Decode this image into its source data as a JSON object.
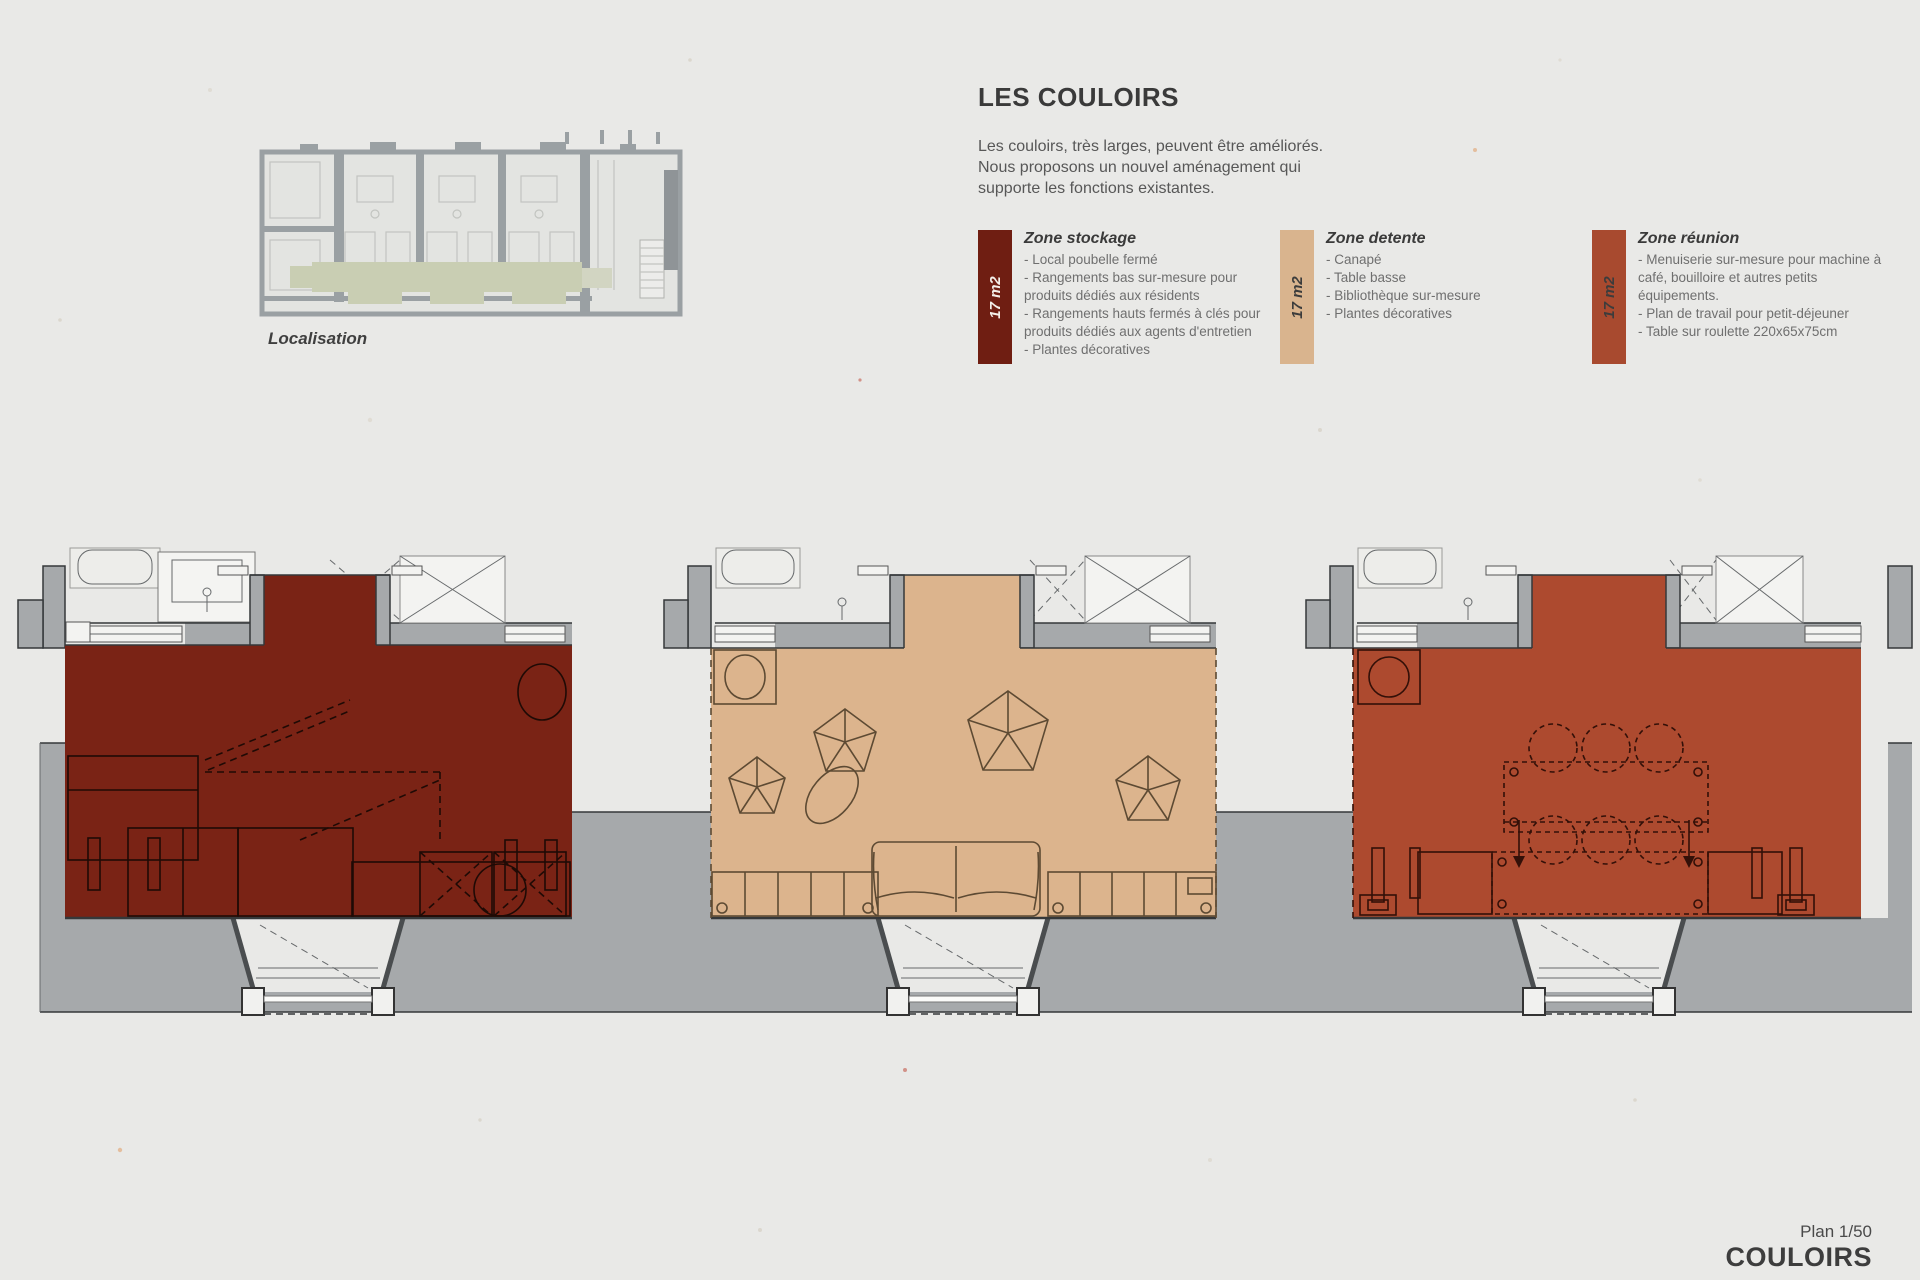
{
  "page": {
    "title": "LES COULOIRS",
    "intro": "Les couloirs, très larges, peuvent être améliorés. Nous proposons un nouvel aménagement qui supporte les fonctions existantes.",
    "map_caption": "Localisation",
    "footer": {
      "scale_label": "Plan 1/50",
      "plan_name": "COULOIRS"
    }
  },
  "zones": [
    {
      "name": "Zone stockage",
      "area_label": "17 m2",
      "color": "#6f1e12",
      "items": [
        "- Local poubelle fermé",
        "- Rangements bas sur-mesure pour produits dédiés aux résidents",
        "- Rangements hauts fermés à clés pour produits dédiés aux agents d'entretien",
        "- Plantes décoratives"
      ]
    },
    {
      "name": "Zone detente",
      "area_label": "17 m2",
      "color": "#d9b48e",
      "items": [
        "- Canapé",
        "- Table basse",
        "- Bibliothèque sur-mesure",
        "- Plantes décoratives"
      ]
    },
    {
      "name": "Zone réunion",
      "area_label": "17 m2",
      "color": "#a84a2f",
      "items": [
        "- Menuiserie sur-mesure pour machine à café, bouilloire et autres petits équipements.",
        "- Plan de travail pour petit-déjeuner",
        "- Table sur roulette 220x65x75cm"
      ]
    }
  ],
  "plan_colors": {
    "stockage": "#7a2315",
    "detente": "#dcb48d",
    "reunion": "#ad4a2f",
    "wall_gray": "#a6a9ab",
    "corridor_highlight_green": "#c9ceb3",
    "paper": "#e9e9e7"
  }
}
